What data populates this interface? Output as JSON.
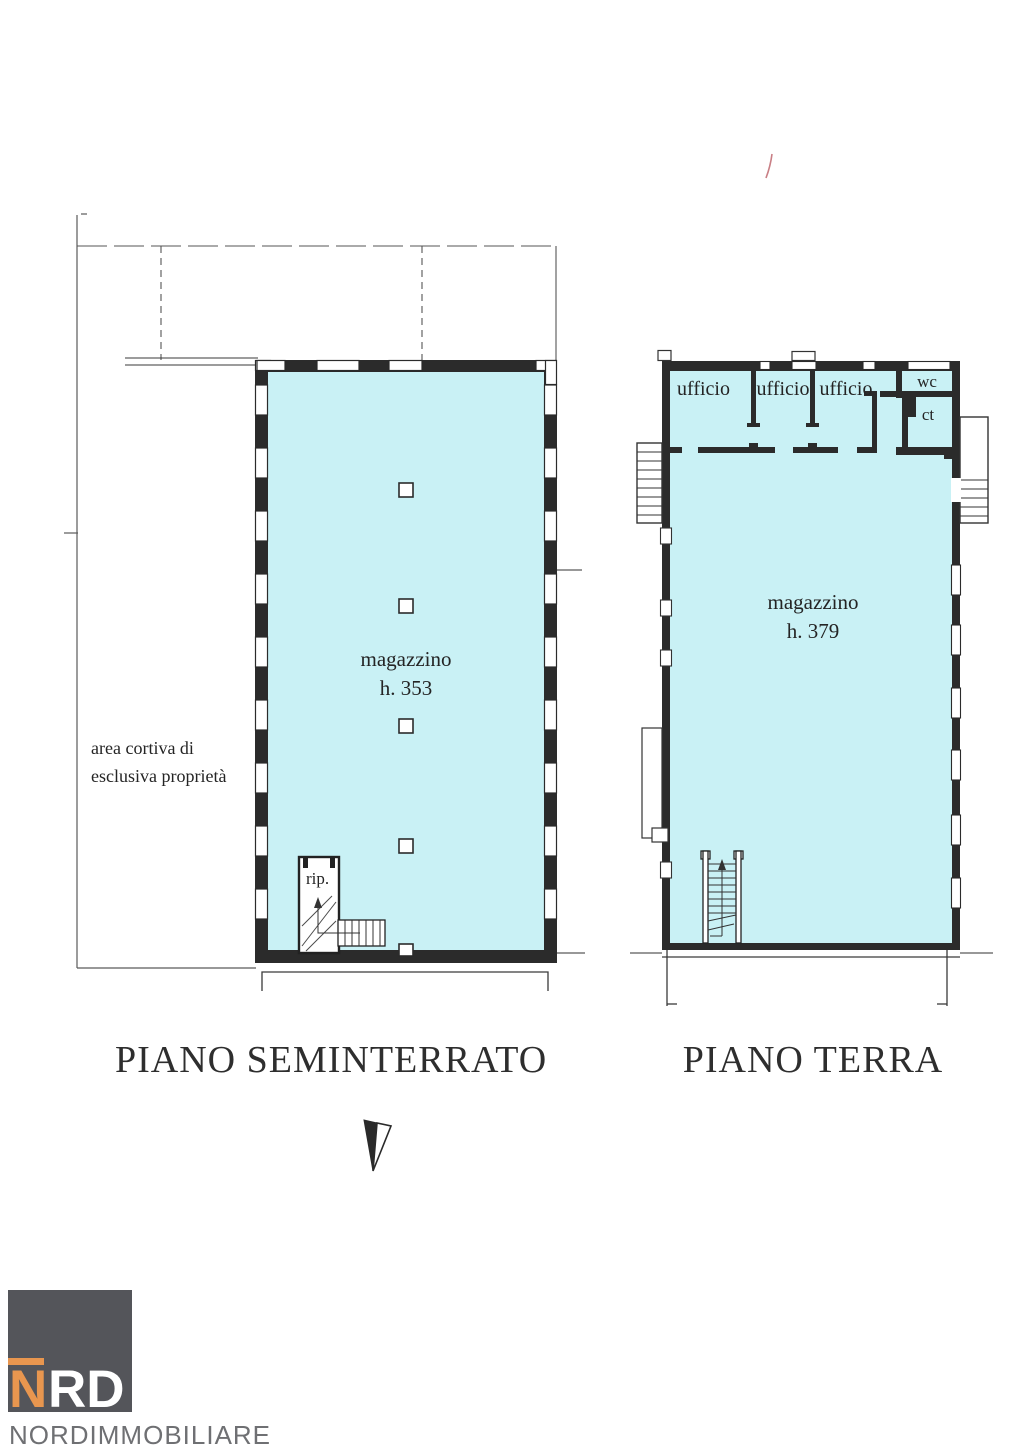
{
  "plans": {
    "seminterrato": {
      "title": "PIANO SEMINTERRATO",
      "room_label": "magazzino",
      "room_height_label": "h. 353",
      "closet_label": "rip.",
      "courtyard_label_line1": "area cortiva di",
      "courtyard_label_line2": "esclusiva proprietà"
    },
    "terra": {
      "title": "PIANO TERRA",
      "room_label": "magazzino",
      "room_height_label": "h. 379",
      "office_labels": [
        "ufficio",
        "ufficio",
        "ufficio"
      ],
      "wc_label": "wc",
      "ct_label": "ct"
    }
  },
  "logo": {
    "monogram_n": "N",
    "monogram_rd": "RD",
    "company_name": "NORDIMMOBILIARE"
  },
  "colors": {
    "floor_fill": "#c9f1f5",
    "wall": "#2b2b2b",
    "logo_orange": "#e8964f",
    "logo_square": "#54555a",
    "logo_text": "#6f7073",
    "pen_mark": "#c97f85"
  }
}
